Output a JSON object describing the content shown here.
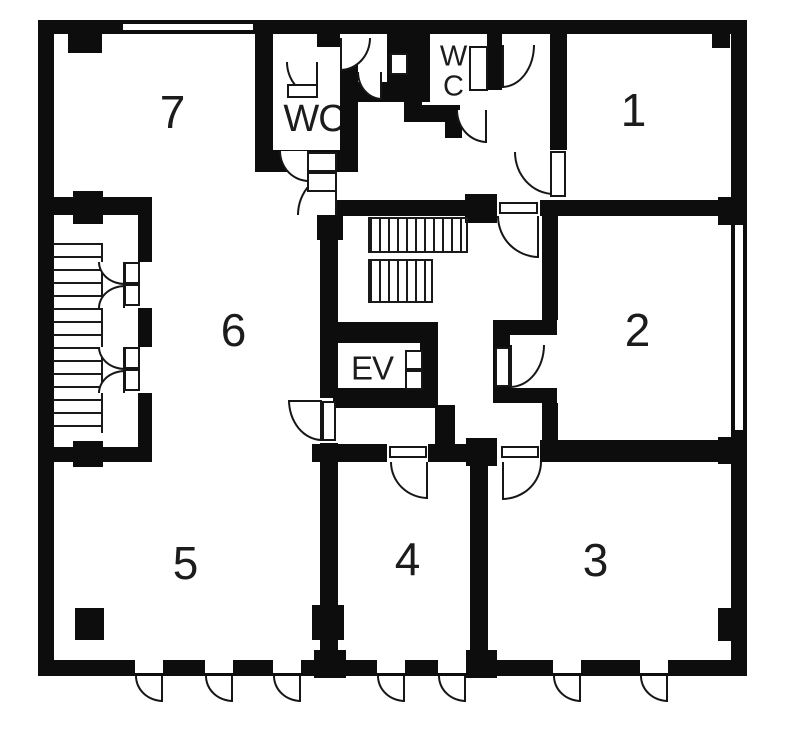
{
  "meta": {
    "canvas": {
      "w": 800,
      "h": 732
    },
    "background_color": "#ffffff",
    "wall_color": "#0d0d0d",
    "line_color": "#161616"
  },
  "labels": {
    "room1": {
      "text": "1",
      "x": 633,
      "y": 110,
      "size": 46
    },
    "room2": {
      "text": "2",
      "x": 637,
      "y": 330,
      "size": 46
    },
    "room3": {
      "text": "3",
      "x": 595,
      "y": 560,
      "size": 46
    },
    "room4": {
      "text": "4",
      "x": 407,
      "y": 559,
      "size": 46
    },
    "room5": {
      "text": "5",
      "x": 185,
      "y": 563,
      "size": 46
    },
    "room6": {
      "text": "6",
      "x": 233,
      "y": 330,
      "size": 46
    },
    "room7": {
      "text": "7",
      "x": 172,
      "y": 112,
      "size": 46
    },
    "wc_left": {
      "text": "WC",
      "x": 314,
      "y": 119,
      "size": 38
    },
    "wc_right_line1": {
      "text": "W",
      "x": 453,
      "y": 57,
      "size": 29
    },
    "wc_right_line2": {
      "text": "C",
      "x": 453,
      "y": 87,
      "size": 29
    },
    "elevator": {
      "text": "EV",
      "x": 372,
      "y": 368,
      "size": 33
    }
  },
  "walls": [
    {
      "name": "wall-exterior-top",
      "x": 38,
      "y": 20,
      "w": 709,
      "h": 14
    },
    {
      "name": "wall-exterior-bottom",
      "x": 38,
      "y": 660,
      "w": 709,
      "h": 16
    },
    {
      "name": "wall-exterior-left",
      "x": 38,
      "y": 20,
      "w": 16,
      "h": 656
    },
    {
      "name": "wall-exterior-right",
      "x": 731,
      "y": 20,
      "w": 16,
      "h": 656
    },
    {
      "name": "wall-stairwell-top",
      "x": 38,
      "y": 197,
      "w": 114,
      "h": 18
    },
    {
      "name": "wall-stairwell-right",
      "x": 138,
      "y": 197,
      "w": 14,
      "h": 265
    },
    {
      "name": "wall-stairwell-bottom",
      "x": 38,
      "y": 447,
      "w": 114,
      "h": 15
    },
    {
      "name": "wall-room7-right",
      "x": 255,
      "y": 33,
      "w": 18,
      "h": 117
    },
    {
      "name": "wall-wc-left-bottom",
      "x": 255,
      "y": 150,
      "w": 85,
      "h": 22
    },
    {
      "name": "wall-wc-left-right",
      "x": 340,
      "y": 47,
      "w": 18,
      "h": 125
    },
    {
      "name": "wall-top-stub",
      "x": 317,
      "y": 33,
      "w": 23,
      "h": 14
    },
    {
      "name": "wall-vestibule-bottom",
      "x": 357,
      "y": 82,
      "w": 73,
      "h": 20
    },
    {
      "name": "wall-vestibule-block",
      "x": 387,
      "y": 33,
      "w": 43,
      "h": 49
    },
    {
      "name": "wall-wc-right-left",
      "x": 404,
      "y": 33,
      "w": 18,
      "h": 89
    },
    {
      "name": "wall-wc-right-bottom",
      "x": 404,
      "y": 105,
      "w": 56,
      "h": 17
    },
    {
      "name": "wall-wc-right-stub",
      "x": 445,
      "y": 122,
      "w": 17,
      "h": 16
    },
    {
      "name": "wall-wc-right-right",
      "x": 487,
      "y": 33,
      "w": 15,
      "h": 57
    },
    {
      "name": "wall-room1-left",
      "x": 550,
      "y": 33,
      "w": 17,
      "h": 117
    },
    {
      "name": "wall-corridor-south-west",
      "x": 320,
      "y": 200,
      "w": 145,
      "h": 16
    },
    {
      "name": "wall-corridor-south-east",
      "x": 540,
      "y": 200,
      "w": 207,
      "h": 16
    },
    {
      "name": "wall-hall-west-upper",
      "x": 320,
      "y": 216,
      "w": 18,
      "h": 182
    },
    {
      "name": "wall-hall-west-lower",
      "x": 320,
      "y": 443,
      "w": 18,
      "h": 217
    },
    {
      "name": "wall-hall-east-upper",
      "x": 542,
      "y": 216,
      "w": 16,
      "h": 104
    },
    {
      "name": "wall-room2-alcove-top",
      "x": 493,
      "y": 320,
      "w": 64,
      "h": 15
    },
    {
      "name": "wall-room2-alcove-left",
      "x": 493,
      "y": 320,
      "w": 17,
      "h": 83
    },
    {
      "name": "wall-room2-alcove-bottom",
      "x": 493,
      "y": 388,
      "w": 64,
      "h": 15
    },
    {
      "name": "wall-hall-east-lower",
      "x": 542,
      "y": 403,
      "w": 16,
      "h": 59
    },
    {
      "name": "wall-ev-top",
      "x": 333,
      "y": 322,
      "w": 105,
      "h": 21
    },
    {
      "name": "wall-ev-bottom",
      "x": 333,
      "y": 388,
      "w": 105,
      "h": 20
    },
    {
      "name": "wall-ev-right",
      "x": 420,
      "y": 343,
      "w": 18,
      "h": 45
    },
    {
      "name": "wall-below-ev",
      "x": 435,
      "y": 405,
      "w": 20,
      "h": 43
    },
    {
      "name": "wall-mid-horizontal-a",
      "x": 312,
      "y": 444,
      "w": 75,
      "h": 18
    },
    {
      "name": "wall-mid-horizontal-b",
      "x": 428,
      "y": 444,
      "w": 38,
      "h": 18
    },
    {
      "name": "wall-room2-bottom",
      "x": 540,
      "y": 440,
      "w": 207,
      "h": 22
    },
    {
      "name": "wall-divider-rooms34",
      "x": 470,
      "y": 444,
      "w": 18,
      "h": 232
    },
    {
      "name": "pier-room7-top",
      "x": 68,
      "y": 33,
      "w": 34,
      "h": 20
    },
    {
      "name": "pier-stairwell-top",
      "x": 73,
      "y": 191,
      "w": 30,
      "h": 33
    },
    {
      "name": "pier-stairwell-bottom",
      "x": 73,
      "y": 441,
      "w": 30,
      "h": 26
    },
    {
      "name": "column-room5",
      "x": 75,
      "y": 608,
      "w": 29,
      "h": 32
    },
    {
      "name": "pier-wall6-mid",
      "x": 312,
      "y": 605,
      "w": 32,
      "h": 35
    },
    {
      "name": "pier-wall6-bottom",
      "x": 314,
      "y": 650,
      "w": 32,
      "h": 28
    },
    {
      "name": "pier-divider-top",
      "x": 466,
      "y": 438,
      "w": 31,
      "h": 28
    },
    {
      "name": "pier-divider-bottom",
      "x": 466,
      "y": 650,
      "w": 31,
      "h": 28
    },
    {
      "name": "pier-corridor-south",
      "x": 465,
      "y": 194,
      "w": 32,
      "h": 29
    },
    {
      "name": "pier-hall-nw",
      "x": 317,
      "y": 215,
      "w": 26,
      "h": 25
    },
    {
      "name": "pier-right-room1",
      "x": 718,
      "y": 197,
      "w": 24,
      "h": 28
    },
    {
      "name": "pier-right-room2",
      "x": 718,
      "y": 437,
      "w": 24,
      "h": 27
    },
    {
      "name": "pier-right-room3",
      "x": 718,
      "y": 608,
      "w": 24,
      "h": 33
    },
    {
      "name": "pier-room1-corner",
      "x": 712,
      "y": 33,
      "w": 18,
      "h": 15
    },
    {
      "name": "mullion-right-window",
      "x": 731,
      "y": 322,
      "w": 16,
      "h": 18
    }
  ],
  "windows": [
    {
      "name": "window-top",
      "cls": "win-h",
      "x": 123,
      "y": 22,
      "w": 130,
      "h": 10
    },
    {
      "name": "window-right",
      "cls": "win-v",
      "x": 733,
      "y": 225,
      "w": 12,
      "h": 205
    }
  ],
  "gaps": [
    {
      "name": "gap-stairwell-door-1",
      "x": 138,
      "y": 262,
      "w": 14,
      "h": 46
    },
    {
      "name": "gap-stairwell-door-2",
      "x": 138,
      "y": 347,
      "w": 14,
      "h": 46
    },
    {
      "name": "gap-entry-door-1",
      "x": 135,
      "y": 660,
      "w": 28,
      "h": 13
    },
    {
      "name": "gap-entry-door-2",
      "x": 205,
      "y": 660,
      "w": 28,
      "h": 13
    },
    {
      "name": "gap-entry-door-3",
      "x": 273,
      "y": 660,
      "w": 28,
      "h": 13
    },
    {
      "name": "gap-entry-door-4",
      "x": 377,
      "y": 660,
      "w": 28,
      "h": 13
    },
    {
      "name": "gap-entry-door-5",
      "x": 438,
      "y": 660,
      "w": 28,
      "h": 13
    },
    {
      "name": "gap-entry-door-6",
      "x": 553,
      "y": 660,
      "w": 28,
      "h": 13
    },
    {
      "name": "gap-entry-door-7",
      "x": 640,
      "y": 660,
      "w": 28,
      "h": 13
    }
  ],
  "stairs": [
    {
      "name": "stairs-west",
      "cls": "stair-h",
      "x": 53,
      "y": 243,
      "w": 50,
      "h": 190
    },
    {
      "name": "stairs-main-upper",
      "cls": "stair-v",
      "x": 368,
      "y": 217,
      "w": 100,
      "h": 36
    },
    {
      "name": "stairs-main-lower",
      "cls": "stair-v",
      "x": 368,
      "y": 259,
      "w": 65,
      "h": 44
    }
  ],
  "doors": [
    {
      "name": "door-wc-left",
      "x": 286,
      "y": 62,
      "w": 32,
      "h": 35,
      "hinge": "tr"
    },
    {
      "name": "door-vestibule",
      "x": 340,
      "y": 38,
      "w": 31,
      "h": 33,
      "hinge": "tl"
    },
    {
      "name": "door-vestibule-inner",
      "x": 357,
      "y": 72,
      "w": 25,
      "h": 28,
      "hinge": "tr"
    },
    {
      "name": "door-wc-right",
      "x": 502,
      "y": 45,
      "w": 33,
      "h": 43,
      "hinge": "tl"
    },
    {
      "name": "door-wc-right-south",
      "x": 456,
      "y": 110,
      "w": 31,
      "h": 33,
      "hinge": "tr"
    },
    {
      "name": "door-room1",
      "x": 514,
      "y": 152,
      "w": 40,
      "h": 43,
      "hinge": "tr"
    },
    {
      "name": "door-lobby-hall",
      "x": 497,
      "y": 216,
      "w": 42,
      "h": 42,
      "hinge": "tr"
    },
    {
      "name": "door-corridor-top",
      "x": 279,
      "y": 151,
      "w": 30,
      "h": 31,
      "hinge": "tr"
    },
    {
      "name": "door-corridor-bottom",
      "x": 297,
      "y": 172,
      "w": 40,
      "h": 43,
      "hinge": "br"
    },
    {
      "name": "door-hall-room6",
      "x": 288,
      "y": 400,
      "w": 34,
      "h": 41,
      "hinge": "tr",
      "leafTop": true
    },
    {
      "name": "door-room2",
      "x": 510,
      "y": 345,
      "w": 35,
      "h": 43,
      "hinge": "tl"
    },
    {
      "name": "door-room4",
      "x": 390,
      "y": 462,
      "w": 38,
      "h": 37,
      "hinge": "tr"
    },
    {
      "name": "door-room3",
      "x": 502,
      "y": 462,
      "w": 40,
      "h": 38,
      "hinge": "tl"
    },
    {
      "name": "door-entry-1",
      "x": 135,
      "y": 676,
      "w": 28,
      "h": 26,
      "hinge": "tr"
    },
    {
      "name": "door-entry-2",
      "x": 205,
      "y": 676,
      "w": 28,
      "h": 26,
      "hinge": "tr"
    },
    {
      "name": "door-entry-3",
      "x": 273,
      "y": 676,
      "w": 28,
      "h": 26,
      "hinge": "tr"
    },
    {
      "name": "door-entry-4",
      "x": 377,
      "y": 676,
      "w": 28,
      "h": 26,
      "hinge": "tr"
    },
    {
      "name": "door-entry-5",
      "x": 438,
      "y": 676,
      "w": 28,
      "h": 26,
      "hinge": "tr"
    },
    {
      "name": "door-entry-6",
      "x": 553,
      "y": 676,
      "w": 28,
      "h": 26,
      "hinge": "tr"
    },
    {
      "name": "door-entry-7",
      "x": 640,
      "y": 676,
      "w": 28,
      "h": 26,
      "hinge": "tr"
    },
    {
      "name": "door-stairwell-1a",
      "x": 98,
      "y": 262,
      "w": 27,
      "h": 23,
      "hinge": "tr"
    },
    {
      "name": "door-stairwell-1b",
      "x": 98,
      "y": 285,
      "w": 27,
      "h": 23,
      "hinge": "br"
    },
    {
      "name": "door-stairwell-2a",
      "x": 98,
      "y": 347,
      "w": 27,
      "h": 23,
      "hinge": "tr"
    },
    {
      "name": "door-stairwell-2b",
      "x": 98,
      "y": 370,
      "w": 27,
      "h": 23,
      "hinge": "br"
    }
  ],
  "leaves": [
    {
      "name": "leaf-wc-left",
      "x": 287,
      "y": 84,
      "w": 31,
      "h": 14
    },
    {
      "name": "leaf-vestibule-inner",
      "x": 390,
      "y": 53,
      "w": 18,
      "h": 22
    },
    {
      "name": "leaf-wc-right",
      "x": 469,
      "y": 46,
      "w": 19,
      "h": 45
    },
    {
      "name": "leaf-room1",
      "x": 550,
      "y": 151,
      "w": 16,
      "h": 46
    },
    {
      "name": "leaf-lobby-hall",
      "x": 499,
      "y": 202,
      "w": 39,
      "h": 12
    },
    {
      "name": "leaf-corridor-1",
      "x": 307,
      "y": 152,
      "w": 30,
      "h": 20
    },
    {
      "name": "leaf-corridor-2",
      "x": 307,
      "y": 172,
      "w": 30,
      "h": 20
    },
    {
      "name": "leaf-hall-room6",
      "x": 322,
      "y": 401,
      "w": 14,
      "h": 40
    },
    {
      "name": "leaf-room2",
      "x": 495,
      "y": 347,
      "w": 15,
      "h": 40
    },
    {
      "name": "leaf-room4",
      "x": 389,
      "y": 446,
      "w": 38,
      "h": 12
    },
    {
      "name": "leaf-room3",
      "x": 501,
      "y": 446,
      "w": 38,
      "h": 12
    },
    {
      "name": "leaf-stairwell-1a",
      "x": 124,
      "y": 262,
      "w": 16,
      "h": 22
    },
    {
      "name": "leaf-stairwell-1b",
      "x": 124,
      "y": 284,
      "w": 16,
      "h": 22
    },
    {
      "name": "leaf-stairwell-2a",
      "x": 124,
      "y": 347,
      "w": 16,
      "h": 22
    },
    {
      "name": "leaf-stairwell-2b",
      "x": 124,
      "y": 369,
      "w": 16,
      "h": 22
    },
    {
      "name": "leaf-ev-1",
      "x": 405,
      "y": 350,
      "w": 18,
      "h": 20
    },
    {
      "name": "leaf-ev-2",
      "x": 405,
      "y": 370,
      "w": 18,
      "h": 20
    }
  ]
}
